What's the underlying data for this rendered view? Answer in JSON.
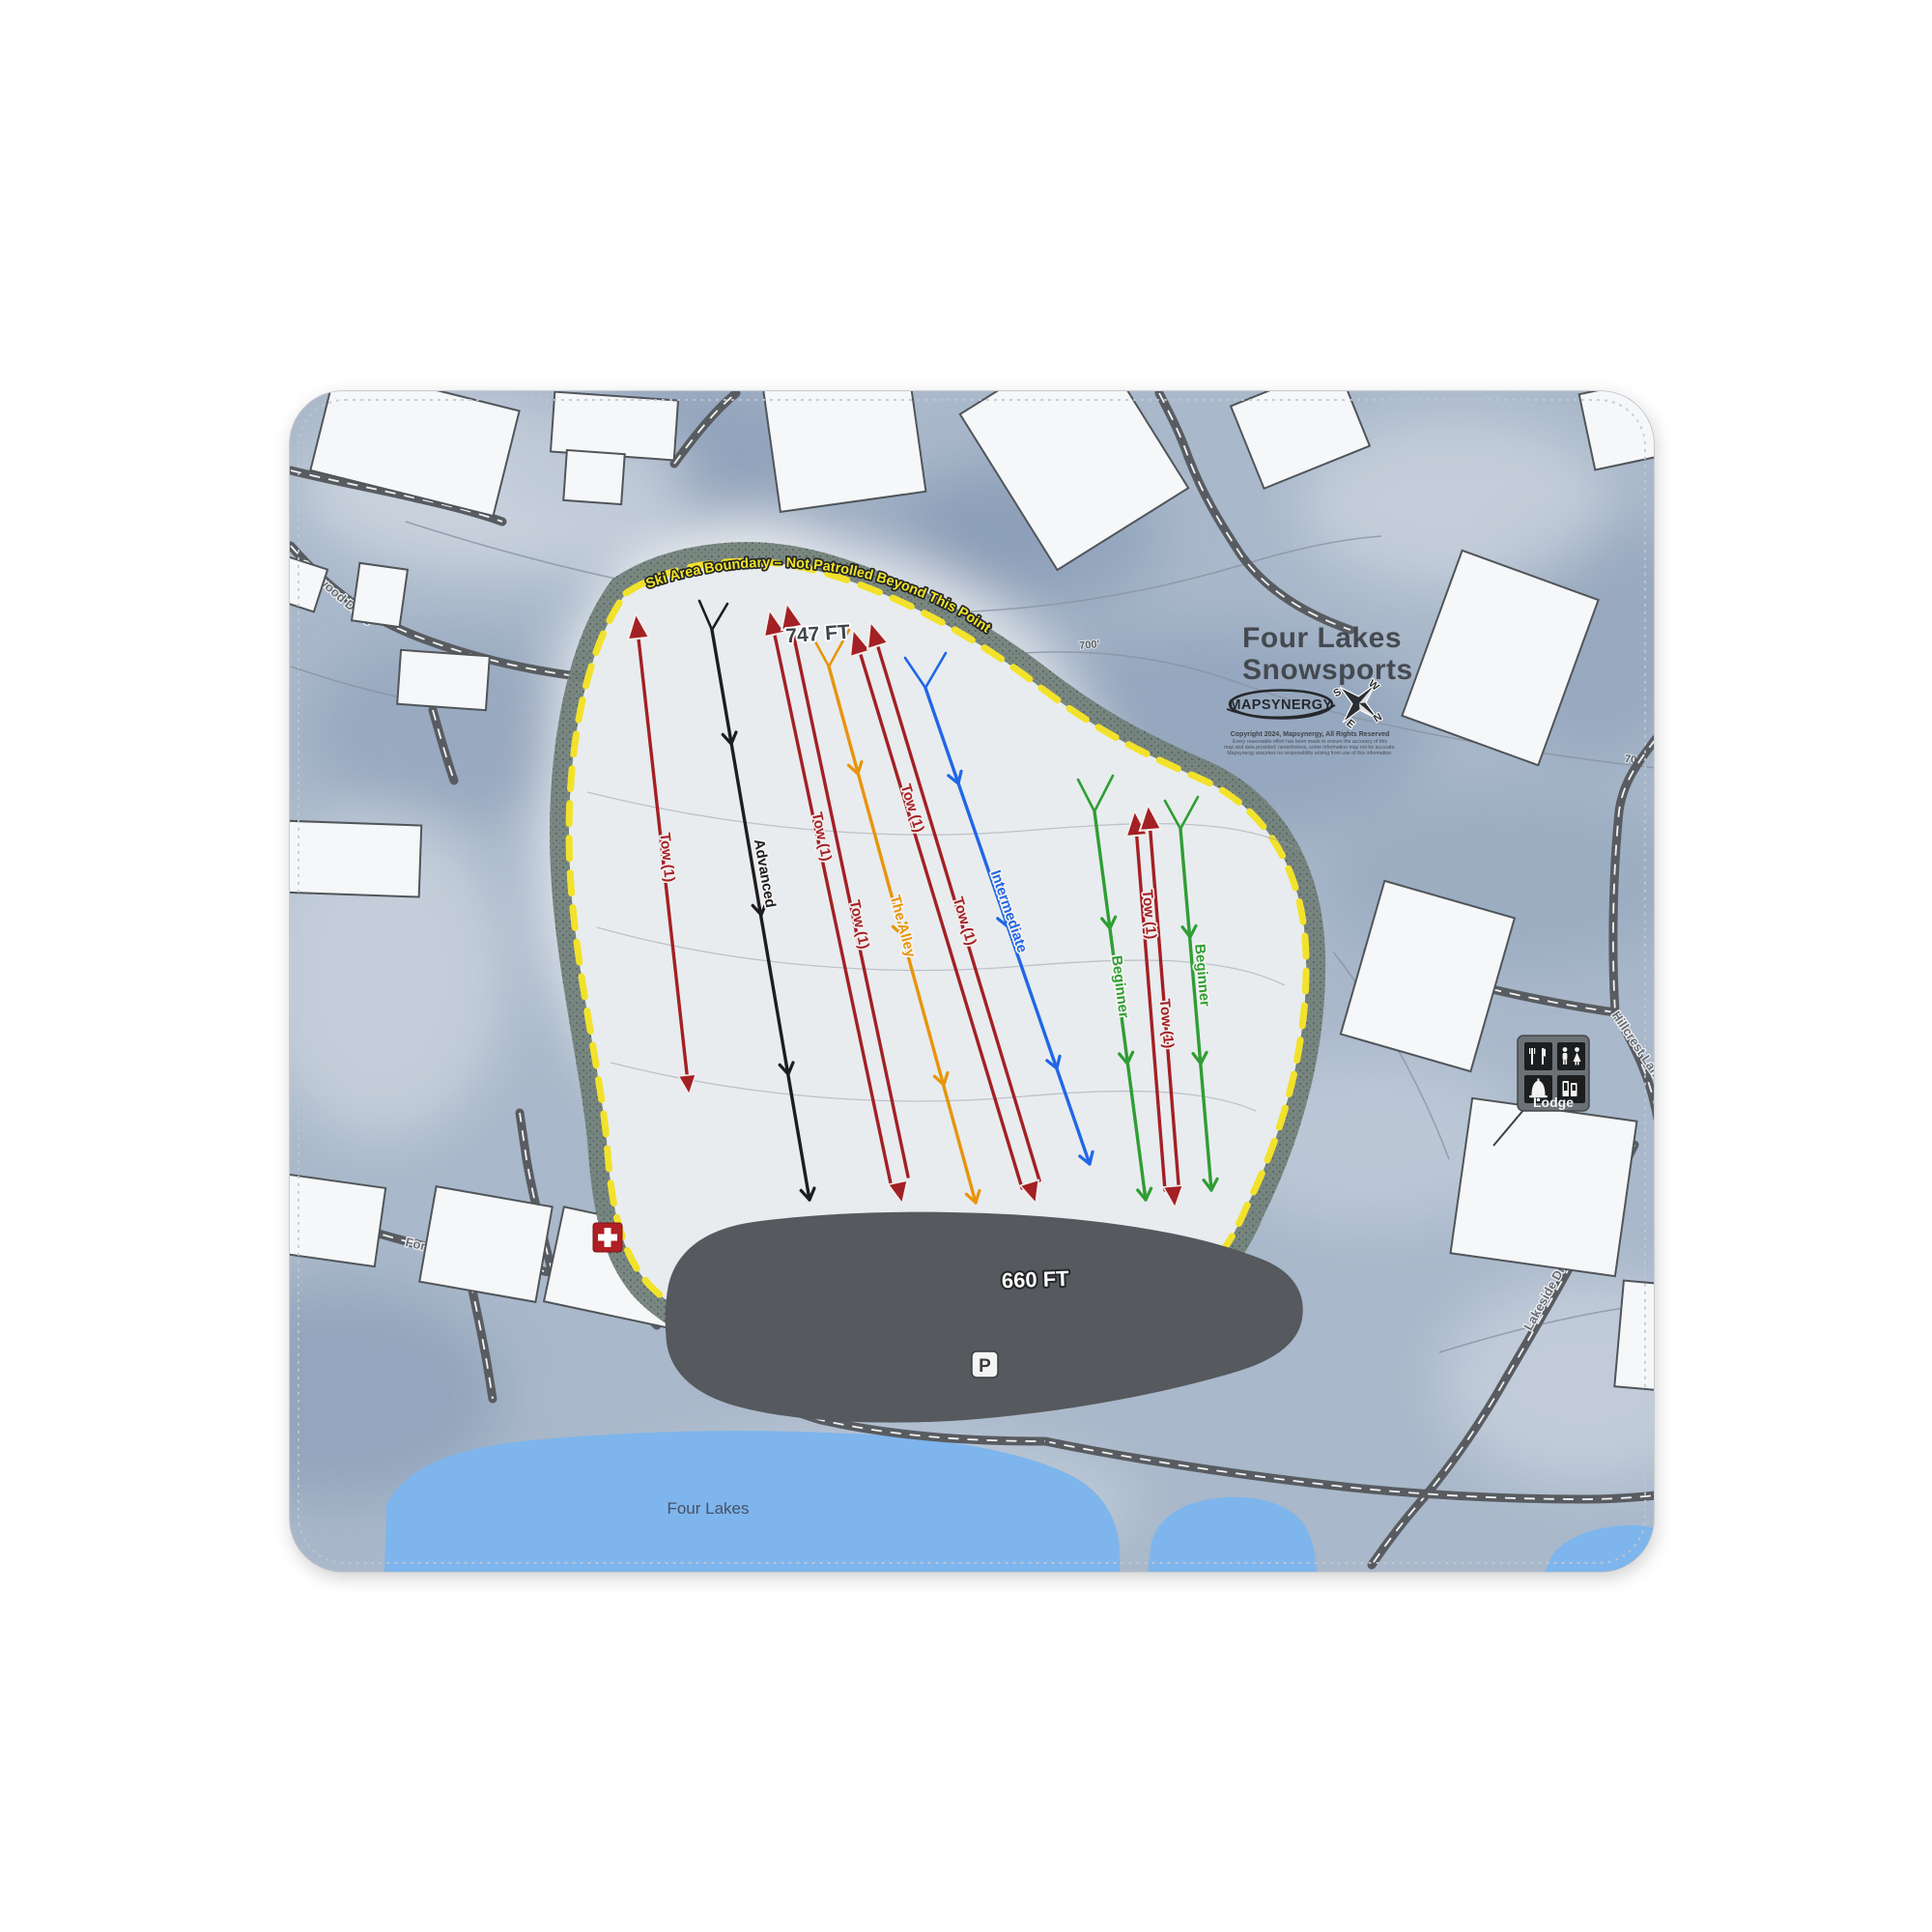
{
  "map": {
    "title_line1": "Four Lakes",
    "title_line2": "Snowsports",
    "logo_text": "MAPSYNERGY",
    "compass": {
      "n": "N",
      "e": "E",
      "s": "S",
      "w": "W"
    },
    "credits_line1": "Copyright 2024, Mapsynergy, All Rights Reserved",
    "credits_line2": "Every reasonable effort has been made to ensure the accuracy of this",
    "credits_line3": "map and data provided; nevertheless, some information may not be accurate.",
    "credits_line4": "Mapsynergy assumes no responsibility arising from use of this information.",
    "boundary_label": "Ski Area Boundary – Not Patrolled Beyond This Point",
    "elevation_summit": "747 FT",
    "elevation_base": "660 FT",
    "contour_label_1": "700'",
    "contour_label_2": "700'",
    "run_advanced": "Advanced",
    "run_alley": "The Alley",
    "run_intermediate": "Intermediate",
    "run_beginner_left": "Beginner",
    "run_beginner_right": "Beginner",
    "tow_a": "Tow (1)",
    "tow_b1": "Tow (1)",
    "tow_b2": "Tow (1)",
    "tow_c1": "Tow (1)",
    "tow_c2": "Tow (1)",
    "tow_d1": "Tow (1)",
    "tow_d2": "Tow (1)",
    "road_oakwood": "Oakwood Drive",
    "road_forest_view": "Forest View Road",
    "road_hillcrest": "Hillcrest Lane",
    "road_lakeside": "Lakeside Drive",
    "lake_label": "Four Lakes",
    "lodge_label": "Lodge",
    "parking_label": "P",
    "colors": {
      "boundary_yellow": "#f2e22b",
      "tow_red": "#a32024",
      "advanced_black": "#1d1d1f",
      "alley_orange": "#e8940c",
      "intermediate_blue": "#2166e8",
      "beginner_green": "#2f9e33",
      "lake_blue": "#7eb5ec",
      "parking_gray": "#56595d",
      "beginner_area_green": "#d6dfc2",
      "alley_tan": "#e9dbb6"
    }
  }
}
